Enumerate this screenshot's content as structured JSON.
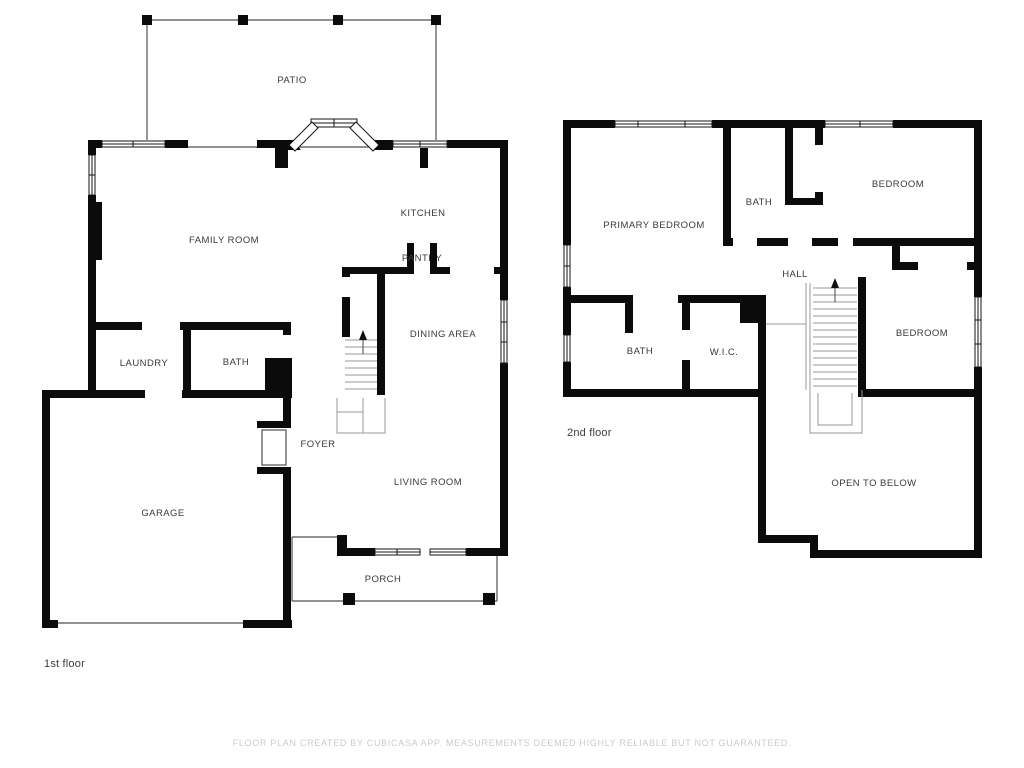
{
  "colors": {
    "wall": "#0b0b0b",
    "outline": "#4f4f4f",
    "stair": "#9a9a9a",
    "window_stroke": "#141414",
    "label": "#3a3a3a",
    "floor_label": "#3c3c3c",
    "footer": "#cbcbcb"
  },
  "floor1": {
    "label": "1st floor",
    "rooms": {
      "patio": "PATIO",
      "family_room": "FAMILY ROOM",
      "kitchen": "KITCHEN",
      "pantry": "PANTRY",
      "dining_area": "DINING AREA",
      "laundry": "LAUNDRY",
      "bath": "BATH",
      "garage": "GARAGE",
      "foyer": "FOYER",
      "living_room": "LIVING ROOM",
      "porch": "PORCH"
    }
  },
  "floor2": {
    "label": "2nd floor",
    "rooms": {
      "primary_bedroom": "PRIMARY BEDROOM",
      "bath_upper": "BATH",
      "bedroom_upper": "BEDROOM",
      "hall": "HALL",
      "bath": "BATH",
      "wic": "W.I.C.",
      "bedroom": "BEDROOM",
      "open_to_below": "OPEN TO BELOW"
    }
  },
  "footer": "FLOOR PLAN CREATED BY CUBICASA APP. MEASUREMENTS DEEMED HIGHLY RELIABLE BUT NOT GUARANTEED."
}
